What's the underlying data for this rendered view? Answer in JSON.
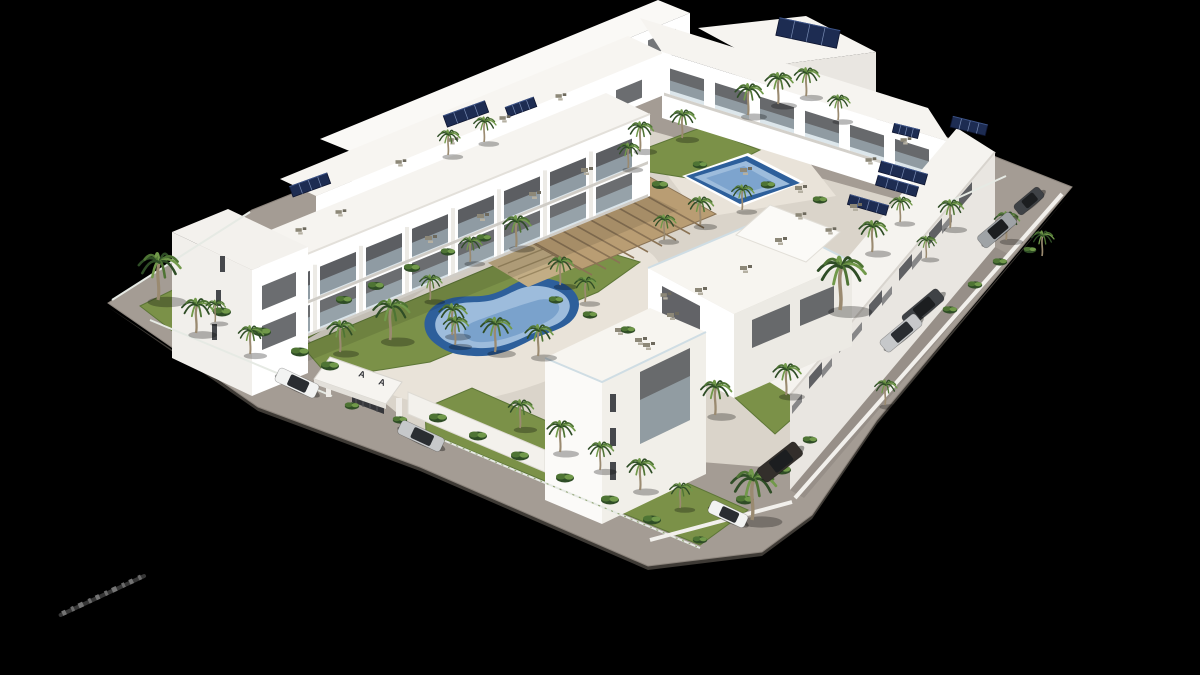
{
  "scene": {
    "kind": "aerial-3d-architectural-render",
    "background": "#000000",
    "entrance": {
      "mark_left": "A",
      "mark_right": "A"
    },
    "colors": {
      "road": "#a49c94",
      "road_edge": "#8d857d",
      "plate_side": "#3e3a35",
      "courtyard": "#dad4ca",
      "pool_deck": "#e9e3d9",
      "pool_ring": "#2d5f9b",
      "pool_water": "#9dbcdc",
      "pool_deep": "#5d8cc0",
      "grass": "#7b9148",
      "grass_dark": "#5d7637",
      "frond_dark": "#2f4d26",
      "frond_mid": "#4e7434",
      "frond_light": "#71994a",
      "trunk": "#9a8a70",
      "wall_white": "#ffffff",
      "wall_light": "#f6f4ef",
      "wall_shade": "#e9e6e1",
      "wall_dark": "#d8d4ce",
      "opening": "#46484c",
      "glass": "#b9cdd8",
      "railing": "#cfdde4",
      "deck_wood": "#b99d73",
      "deck_slat": "#8a7355",
      "step_wood": "#c2ad85",
      "solar": "#1d2c52",
      "solar_line": "#8fa3cc",
      "furniture": "#8d8878",
      "fence": "#e6eae4",
      "watermark": "#8f8f8f"
    },
    "palms": [
      [
        158,
        300,
        1.5
      ],
      [
        196,
        333,
        1.1
      ],
      [
        250,
        354,
        0.9
      ],
      [
        215,
        322,
        0.7
      ],
      [
        340,
        352,
        1.0
      ],
      [
        390,
        340,
        1.3
      ],
      [
        452,
        335,
        1.0
      ],
      [
        516,
        247,
        1.0
      ],
      [
        430,
        300,
        0.8
      ],
      [
        470,
        262,
        0.8
      ],
      [
        560,
        285,
        0.9
      ],
      [
        585,
        302,
        0.8
      ],
      [
        495,
        352,
        1.1
      ],
      [
        538,
        356,
        1.0
      ],
      [
        455,
        345,
        0.9
      ],
      [
        520,
        428,
        0.9
      ],
      [
        560,
        452,
        1.0
      ],
      [
        600,
        470,
        0.9
      ],
      [
        640,
        490,
        1.0
      ],
      [
        680,
        508,
        0.8
      ],
      [
        752,
        520,
        1.6
      ],
      [
        715,
        415,
        1.1
      ],
      [
        840,
        310,
        1.7
      ],
      [
        872,
        252,
        1.0
      ],
      [
        900,
        222,
        0.8
      ],
      [
        700,
        225,
        0.9
      ],
      [
        742,
        210,
        0.8
      ],
      [
        664,
        240,
        0.8
      ],
      [
        628,
        168,
        0.8
      ],
      [
        640,
        150,
        0.9
      ],
      [
        682,
        138,
        0.9
      ],
      [
        748,
        115,
        1.0
      ],
      [
        778,
        104,
        1.0
      ],
      [
        806,
        96,
        0.9
      ],
      [
        838,
        120,
        0.8
      ],
      [
        448,
        155,
        0.8
      ],
      [
        484,
        142,
        0.8
      ],
      [
        950,
        228,
        0.9
      ],
      [
        1006,
        240,
        0.9
      ],
      [
        1042,
        256,
        0.8
      ],
      [
        926,
        258,
        0.7
      ],
      [
        786,
        395,
        1.0
      ],
      [
        885,
        405,
        0.8
      ]
    ],
    "bushes": [
      [
        222,
        312,
        1
      ],
      [
        262,
        332,
        1
      ],
      [
        300,
        352,
        1
      ],
      [
        330,
        366,
        1
      ],
      [
        438,
        418,
        1
      ],
      [
        478,
        436,
        1
      ],
      [
        520,
        456,
        1
      ],
      [
        565,
        478,
        1
      ],
      [
        610,
        500,
        1
      ],
      [
        652,
        520,
        1
      ],
      [
        700,
        540,
        0.8
      ],
      [
        745,
        500,
        1
      ],
      [
        782,
        470,
        1
      ],
      [
        810,
        440,
        0.8
      ],
      [
        950,
        310,
        0.8
      ],
      [
        975,
        285,
        0.8
      ],
      [
        1000,
        262,
        0.8
      ],
      [
        1030,
        250,
        0.7
      ],
      [
        660,
        185,
        0.9
      ],
      [
        700,
        165,
        0.8
      ],
      [
        768,
        185,
        0.8
      ],
      [
        820,
        200,
        0.8
      ],
      [
        352,
        406,
        0.8
      ],
      [
        400,
        420,
        0.8
      ],
      [
        344,
        300,
        0.9
      ],
      [
        376,
        286,
        0.9
      ],
      [
        412,
        268,
        0.9
      ],
      [
        448,
        252,
        0.8
      ],
      [
        484,
        238,
        0.8
      ],
      [
        556,
        300,
        0.8
      ],
      [
        590,
        315,
        0.8
      ],
      [
        628,
        330,
        0.8
      ]
    ],
    "cars": [
      [
        297,
        383,
        25,
        44,
        15,
        "#f2f3f2",
        "#2a2d31"
      ],
      [
        421,
        436,
        25,
        47,
        15,
        "#c6c8ca",
        "#2a2d31"
      ],
      [
        728,
        514,
        25,
        40,
        14,
        "#f2f3f2",
        "#2a2d31"
      ],
      [
        780,
        462,
        -38,
        48,
        17,
        "#332f2b",
        "#1c1e20"
      ],
      [
        1029,
        201,
        -40,
        32,
        13,
        "#3f4246",
        "#1c1e20"
      ],
      [
        997,
        230,
        -40,
        42,
        15,
        "#9fa3a6",
        "#1c1e20"
      ],
      [
        923,
        308,
        -40,
        46,
        15,
        "#3f4246",
        "#1c1e20"
      ],
      [
        901,
        333,
        -40,
        46,
        15,
        "#c6c8ca",
        "#2a2d31"
      ]
    ],
    "solar_panels": [
      [
        969,
        126,
        36,
        11,
        14
      ],
      [
        906,
        131,
        26,
        9,
        14
      ],
      [
        903,
        173,
        48,
        11,
        16
      ],
      [
        897,
        186,
        42,
        10,
        16
      ],
      [
        868,
        205,
        40,
        10,
        16
      ],
      [
        466,
        114,
        44,
        12,
        -20
      ],
      [
        521,
        107,
        30,
        10,
        -20
      ],
      [
        310,
        185,
        40,
        11,
        -20
      ],
      [
        808,
        33,
        62,
        18,
        12
      ]
    ],
    "roof_furniture": [
      [
        430,
        238,
        1
      ],
      [
        482,
        216,
        1
      ],
      [
        534,
        194,
        1
      ],
      [
        586,
        170,
        1
      ],
      [
        400,
        162,
        0.9
      ],
      [
        452,
        140,
        0.9
      ],
      [
        504,
        118,
        0.9
      ],
      [
        560,
        96,
        0.9
      ],
      [
        300,
        230,
        0.9
      ],
      [
        340,
        212,
        0.9
      ],
      [
        745,
        170,
        1
      ],
      [
        800,
        188,
        1
      ],
      [
        855,
        206,
        1
      ],
      [
        700,
        290,
        1
      ],
      [
        745,
        268,
        1
      ],
      [
        672,
        315,
        1
      ],
      [
        640,
        340,
        1
      ],
      [
        780,
        240,
        1
      ],
      [
        905,
        140,
        0.9
      ],
      [
        870,
        160,
        0.9
      ],
      [
        620,
        330,
        1
      ],
      [
        648,
        345,
        1
      ],
      [
        800,
        215,
        0.9
      ],
      [
        830,
        230,
        0.9
      ],
      [
        665,
        295,
        0.9
      ]
    ]
  }
}
